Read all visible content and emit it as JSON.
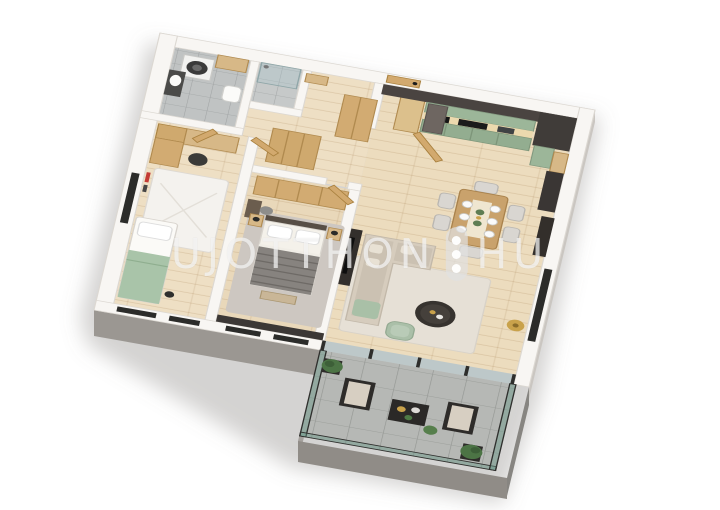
{
  "scene": {
    "type": "3d-floor-plan-render",
    "background_color": "#ffffff",
    "projection": "oblique-isometric"
  },
  "watermark": {
    "left": "UJOTTHON",
    "right": "HU",
    "separator_icon": "three-dot-pill",
    "color": "rgba(250,250,250,0.68)"
  },
  "palette": {
    "wall_top": "#f8f6f3",
    "facade_west": "#b3afab",
    "facade_south": "#9b9792",
    "wood_floor": "#ecdcbe",
    "cabinet_wood": "#d2a96e",
    "kitchen_green": "#9cb699",
    "kitchen_dark": "#44403d",
    "bath_tile": "#c0c3c3",
    "terrace_tile": "#b6b8b5",
    "sofa_beige": "#d6ccbd",
    "accent_green": "#a9c0a7",
    "bedding_grey": "#87837f",
    "gold": "#c9a24b",
    "glass": "rgba(130,170,155,0.45)",
    "window_slot": "#2c2c2a"
  },
  "rooms": [
    {
      "name": "bathroom",
      "items": [
        "washing-machine",
        "vanity-sink",
        "toilet",
        "upper-cabinet"
      ]
    },
    {
      "name": "shower-room",
      "items": [
        "shower"
      ]
    },
    {
      "name": "hallway",
      "items": [
        "front-door",
        "entry-console",
        "wardrobe",
        "closet",
        "tall-cabinet"
      ]
    },
    {
      "name": "kids-room",
      "items": [
        "desk",
        "shelves",
        "chair",
        "rug",
        "single-bed-green-blanket",
        "wall-art"
      ]
    },
    {
      "name": "master-bedroom",
      "items": [
        "wardrobe-row",
        "double-bed",
        "nightstands",
        "vanity-table",
        "bench",
        "rug",
        "dark-accent-wall"
      ]
    },
    {
      "name": "kitchen",
      "items": [
        "fridge",
        "green-cabinets",
        "oven",
        "cooktop",
        "sink",
        "dark-wall-panels",
        "tall-dark-units"
      ]
    },
    {
      "name": "dining-area",
      "items": [
        "dining-table",
        "six-chairs",
        "sideboard",
        "tableware"
      ]
    },
    {
      "name": "living-room",
      "items": [
        "corner-sofa",
        "round-coffee-table",
        "rug",
        "green-armchair",
        "gold-floor-lamp",
        "tv-cabinet",
        "glass-slider"
      ]
    },
    {
      "name": "terrace",
      "items": [
        "glass-balustrade",
        "two-lounge-chairs",
        "coffee-table",
        "planters",
        "plants"
      ]
    }
  ]
}
